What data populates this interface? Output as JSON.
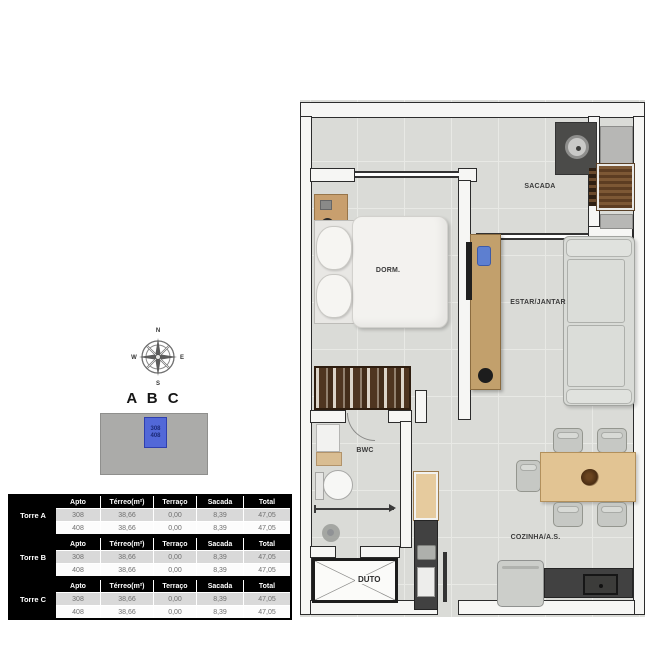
{
  "compass": {
    "n": "N",
    "e": "E",
    "s": "S",
    "w": "W"
  },
  "building": {
    "title": "A B C",
    "unit_top": "308",
    "unit_bottom": "408"
  },
  "tables": [
    {
      "torre": "Torre A",
      "header": [
        "Apto",
        "Térreo(m²)",
        "Terraço",
        "Sacada",
        "Total"
      ],
      "rows": [
        [
          "308",
          "38,66",
          "0,00",
          "8,39",
          "47,05"
        ],
        [
          "408",
          "38,66",
          "0,00",
          "8,39",
          "47,05"
        ]
      ]
    },
    {
      "torre": "Torre B",
      "header": [
        "Apto",
        "Térreo(m²)",
        "Terraço",
        "Sacada",
        "Total"
      ],
      "rows": [
        [
          "308",
          "38,66",
          "0,00",
          "8,39",
          "47,05"
        ],
        [
          "408",
          "38,66",
          "0,00",
          "8,39",
          "47,05"
        ]
      ]
    },
    {
      "torre": "Torre C",
      "header": [
        "Apto",
        "Térreo(m²)",
        "Terraço",
        "Sacada",
        "Total"
      ],
      "rows": [
        [
          "308",
          "38,66",
          "0,00",
          "8,39",
          "47,05"
        ],
        [
          "408",
          "38,66",
          "0,00",
          "8,39",
          "47,05"
        ]
      ]
    }
  ],
  "floorplan": {
    "labels": {
      "sacada": "SACADA",
      "dorm": "DORM.",
      "estar": "ESTAR/JANTAR",
      "bwc": "BWC",
      "duto": "DUTO",
      "cozinha": "COZINHA/A.S."
    }
  },
  "colors": {
    "highlight_blue": "#5268d8",
    "table_header_bg": "#000000",
    "table_row_alt": "#d9d9d9",
    "floor": "#dadbd7",
    "wall": "#f6f6f4",
    "wall_edge": "#2c2c2c",
    "wood_light": "#e2c493",
    "wood_mid": "#c2a06c",
    "wood_dark": "#4f3520",
    "counter_dark": "#414141"
  }
}
